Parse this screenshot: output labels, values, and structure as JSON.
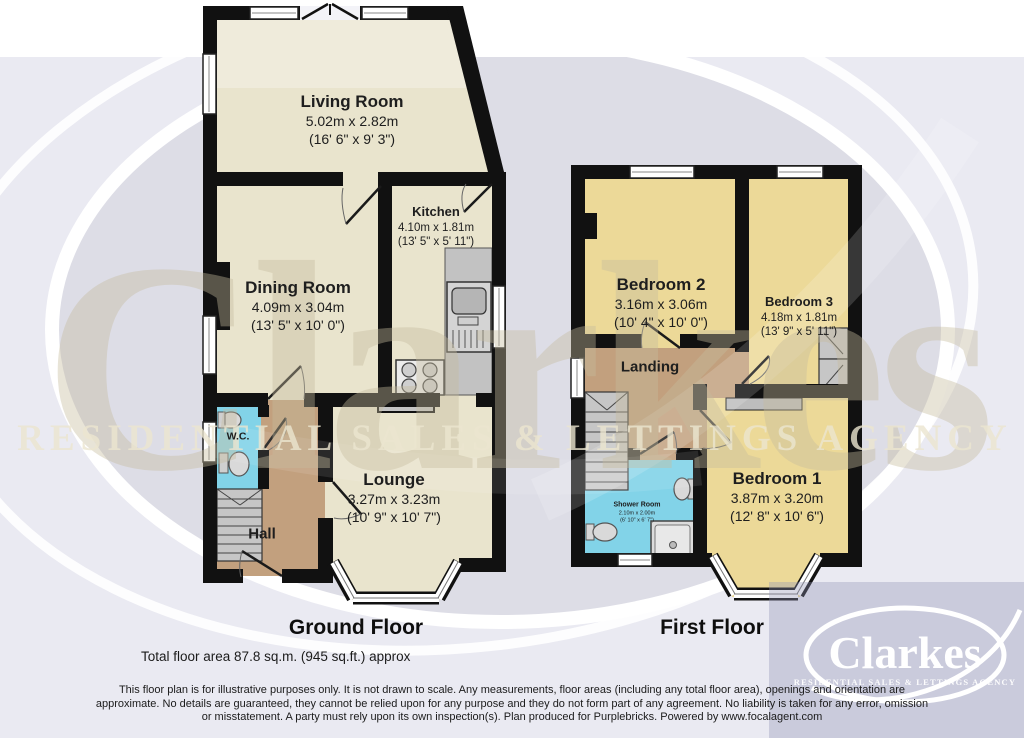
{
  "watermark": {
    "brand": "Clarkes",
    "tagline": "RESIDENTIAL SALES & LETTINGS AGENCY"
  },
  "logo": {
    "brand": "Clarkes",
    "tagline": "RESIDENTIAL SALES & LETTINGS AGENCY"
  },
  "ground_floor": {
    "label": "Ground Floor",
    "rooms": {
      "living": {
        "name": "Living Room",
        "metric": "5.02m x 2.82m",
        "imperial": "(16' 6\" x 9' 3\")"
      },
      "kitchen": {
        "name": "Kitchen",
        "metric": "4.10m x 1.81m",
        "imperial": "(13' 5\" x 5' 11\")"
      },
      "dining": {
        "name": "Dining Room",
        "metric": "4.09m x 3.04m",
        "imperial": "(13' 5\" x 10' 0\")"
      },
      "wc": {
        "name": "W.C."
      },
      "lounge": {
        "name": "Lounge",
        "metric": "3.27m x 3.23m",
        "imperial": "(10' 9\" x 10' 7\")"
      },
      "hall": {
        "name": "Hall"
      }
    }
  },
  "first_floor": {
    "label": "First Floor",
    "rooms": {
      "bedroom2": {
        "name": "Bedroom 2",
        "metric": "3.16m x 3.06m",
        "imperial": "(10' 4\" x 10' 0\")"
      },
      "bedroom3": {
        "name": "Bedroom 3",
        "metric": "4.18m x 1.81m",
        "imperial": "(13' 9\" x 5' 11\")"
      },
      "landing": {
        "name": "Landing"
      },
      "shower": {
        "name": "Shower Room",
        "metric": "2.10m x 2.00m",
        "imperial": "(6' 10\" x 6' 7\")"
      },
      "bedroom1": {
        "name": "Bedroom 1",
        "metric": "3.87m x 3.20m",
        "imperial": "(12' 8\" x 10' 6\")"
      }
    }
  },
  "footer": {
    "total_area": "Total floor area 87.8 sq.m. (945 sq.ft.) approx",
    "disclaimer_line1": "This floor plan is for illustrative purposes only. It is not drawn to scale. Any measurements, floor areas (including any total floor area), openings and orientation are",
    "disclaimer_line2": "approximate. No details are guaranteed, they cannot be relied upon for any purpose and they do not form part of any agreement. No liability is taken for any error, omission",
    "disclaimer_line3": "or misstatement. A party must rely upon its own inspection(s). Plan produced for Purplebricks. Powered by www.focalagent.com"
  },
  "colors": {
    "background": "#eaeaf2",
    "floor_cream": "#e9e4cd",
    "floor_yellow": "#ecd998",
    "floor_brown": "#c2a07e",
    "floor_cyan": "#82d3e8",
    "wall_black": "#111111",
    "fixture_gray": "#c6c6c6",
    "logo_panel": "#8e93b4",
    "watermark_text": "#c6bc9e"
  }
}
